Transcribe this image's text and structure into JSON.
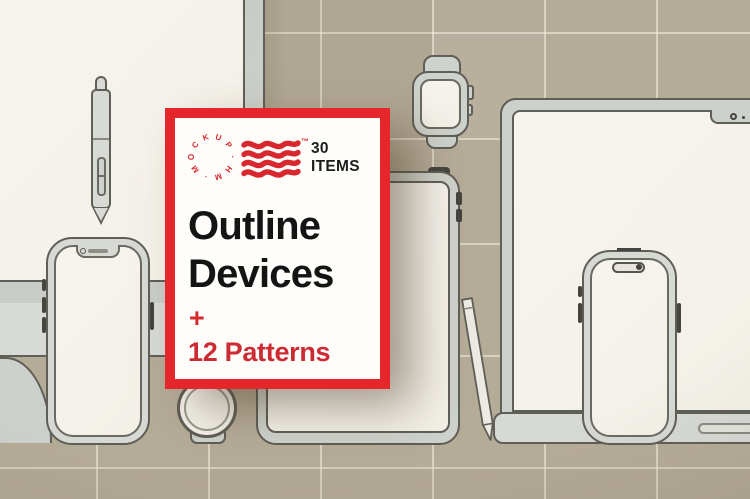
{
  "card": {
    "badge_count": "30",
    "badge_label": "ITEMS",
    "title_line1": "Outline",
    "title_line2": "Devices",
    "plus": "+",
    "subtitle": "12 Patterns",
    "trademark": "™",
    "logo_letters": [
      "M",
      "O",
      "C",
      "K",
      "U",
      "P",
      "·",
      "H",
      "M",
      "·"
    ]
  },
  "colors": {
    "accent_red": "#e5262a",
    "icon_red": "#d8272e",
    "text_red": "#cc2b33",
    "text_black": "#141414",
    "wall_tan": "#b5ac98",
    "grid_line": "#f6f1e5",
    "surface_offwhite": "#f5f2eb",
    "device_gray": "#ced2cc",
    "outline_gray": "#5f5e57"
  },
  "scene": {
    "items": [
      "desktop-monitor",
      "stylus-pen",
      "iphone-notch",
      "round-smartwatch",
      "tablet",
      "apple-pencil",
      "smartwatch",
      "laptop",
      "iphone-dynamic-island"
    ]
  }
}
